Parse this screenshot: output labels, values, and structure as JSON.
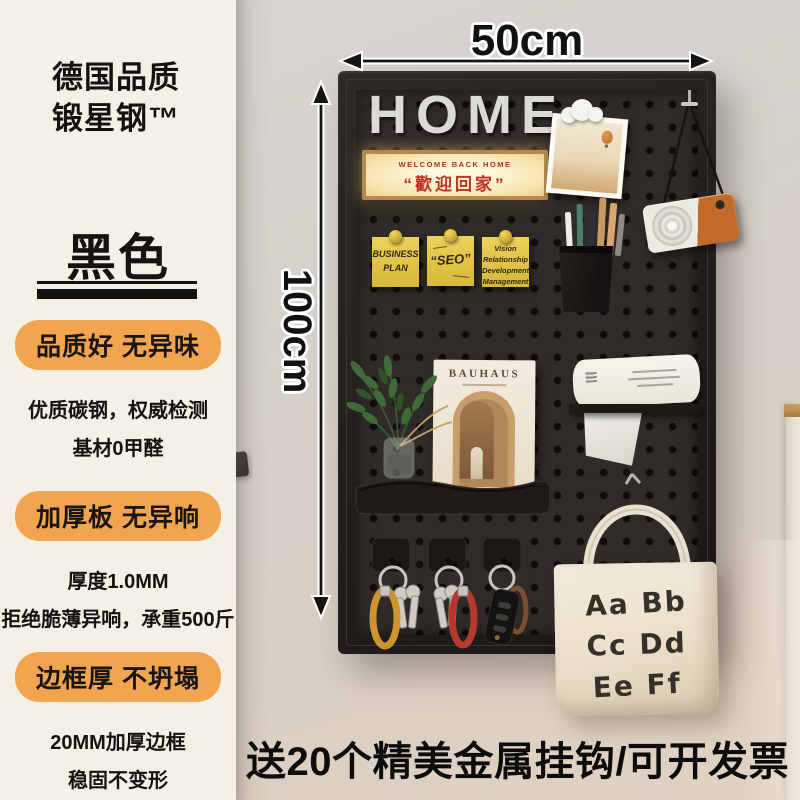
{
  "brand": {
    "line1": "德国品质",
    "line2": "锻星钢™"
  },
  "variant": {
    "name": "黑色"
  },
  "features": [
    {
      "badge": "品质好 无异味",
      "line1": "优质碳钢，权威检测",
      "line2": "基材0甲醛"
    },
    {
      "badge": "加厚板 无异响",
      "line1": "厚度1.0MM",
      "line2": "拒绝脆薄异响，承重500斤"
    },
    {
      "badge": "边框厚 不坍塌",
      "line1": "20MM加厚边框",
      "line2": "稳固不变形"
    }
  ],
  "dimensions": {
    "width": "50cm",
    "height": "100cm"
  },
  "board": {
    "title": "HOME",
    "welcome_sign": {
      "en": "WELCOME BACK HOME",
      "zh": "“歡迎回家”"
    },
    "sticky_notes": [
      {
        "text": "BUSINESS\nPLAN"
      },
      {
        "text": "“SEO”"
      },
      {
        "text": "Vision\nRelationship\nDevelopment\nManagement"
      }
    ],
    "magazine": {
      "title": "BAUHAUS"
    },
    "tote_bag": {
      "line1": "Aa Bb",
      "line2": "Cc Dd",
      "line3": "Ee Ff"
    }
  },
  "footer": {
    "slogan": "送20个精美金属挂钩/可开发票"
  },
  "colors": {
    "badge_orange": "#f2a44e",
    "board_black": "#2b2724",
    "sign_red": "#c0301f",
    "panel_cream": "#f5f0e6"
  }
}
